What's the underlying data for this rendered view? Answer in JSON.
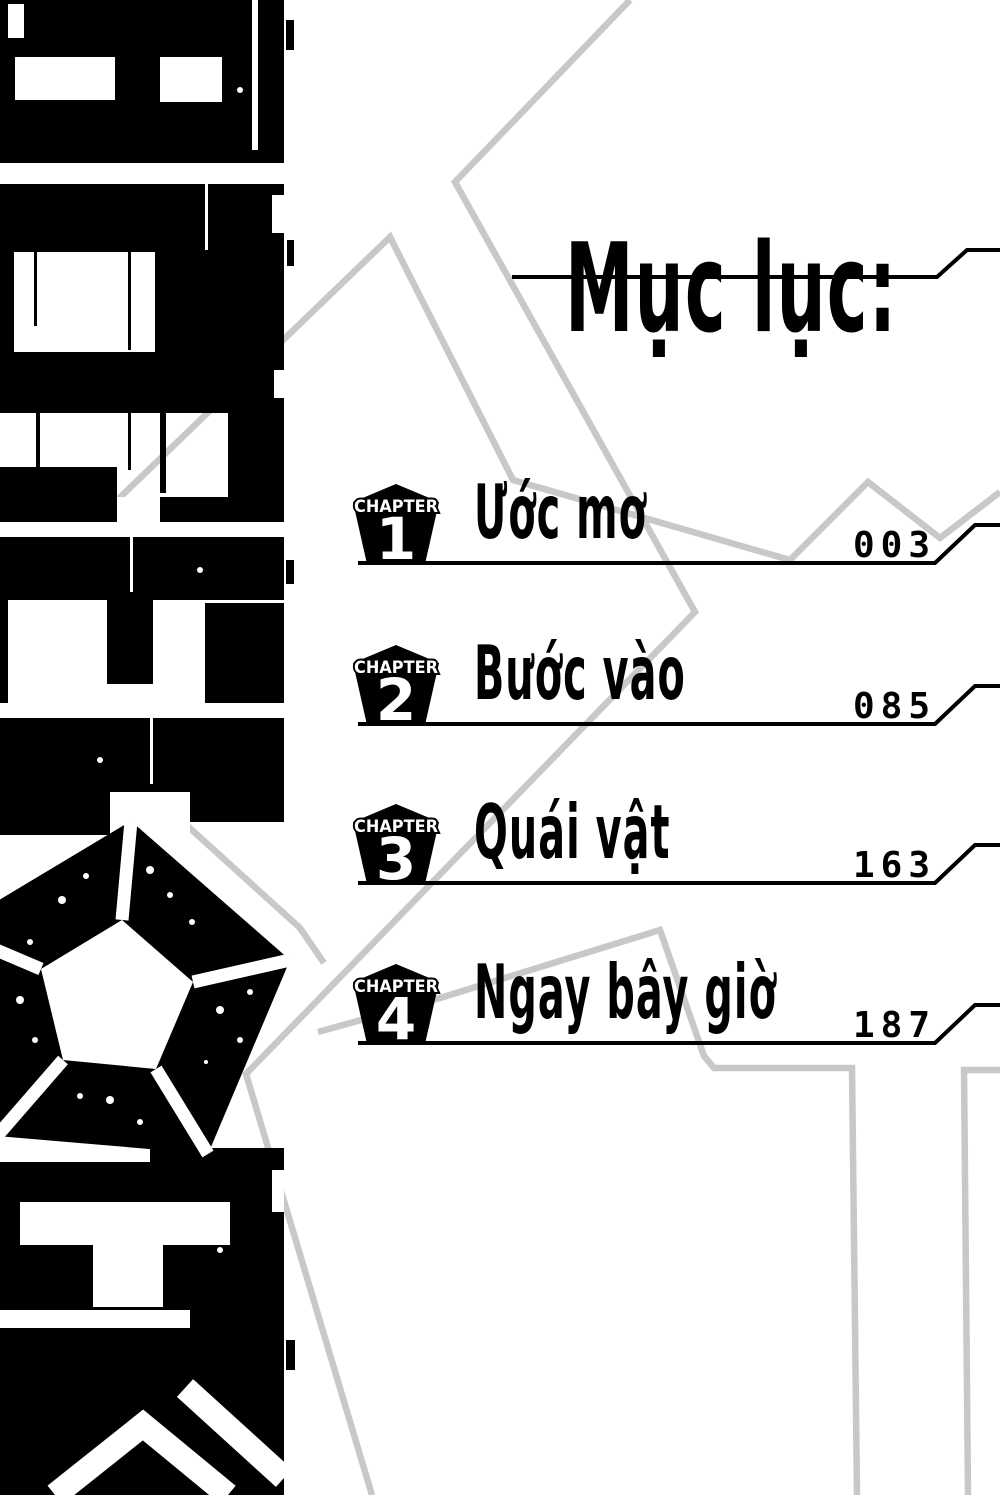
{
  "colors": {
    "ink": "#000000",
    "paper": "#ffffff",
    "trace": "#c8c8c8"
  },
  "header": {
    "title": "Mục lục:"
  },
  "chapters": [
    {
      "badge_label": "CHAPTER",
      "number": "1",
      "title": "Ước mơ",
      "page": "003"
    },
    {
      "badge_label": "CHAPTER",
      "number": "2",
      "title": "Bước vào",
      "page": "085"
    },
    {
      "badge_label": "CHAPTER",
      "number": "3",
      "title": "Quái vật",
      "page": "163"
    },
    {
      "badge_label": "CHAPTER",
      "number": "4",
      "title": "Ngay bây giờ",
      "page": "187"
    }
  ],
  "art": {
    "icon": "pentagon-burst-icon",
    "style": "distressed-black-spine-logo"
  }
}
